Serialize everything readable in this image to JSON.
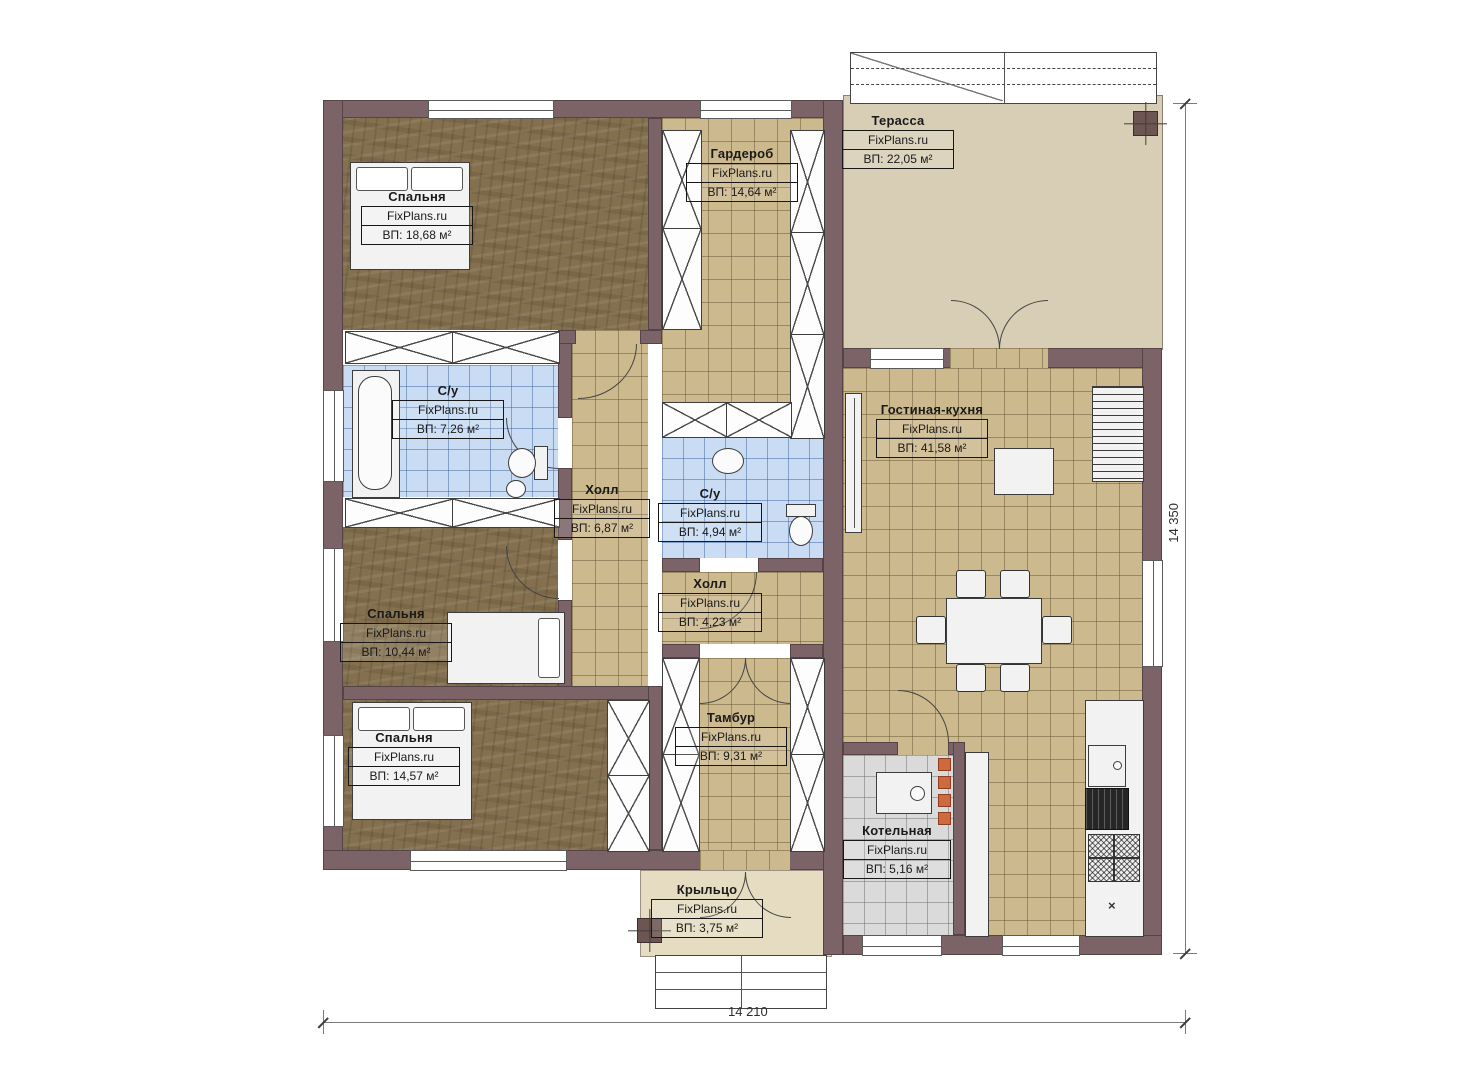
{
  "watermark": "FixPlans.ru",
  "rooms": [
    {
      "id": "bedroom-1",
      "name": "Спальня",
      "area": "ВП: 18,68 м²"
    },
    {
      "id": "wardrobe",
      "name": "Гардероб",
      "area": "ВП: 14,64 м²"
    },
    {
      "id": "terrace",
      "name": "Терасса",
      "area": "ВП: 22,05 м²"
    },
    {
      "id": "bath-1",
      "name": "С/у",
      "area": "ВП: 7,26 м²"
    },
    {
      "id": "hall-1",
      "name": "Холл",
      "area": "ВП: 6,87 м²"
    },
    {
      "id": "bath-2",
      "name": "С/у",
      "area": "ВП: 4,94 м²"
    },
    {
      "id": "living-kitchen",
      "name": "Гостиная-кухня",
      "area": "ВП: 41,58 м²"
    },
    {
      "id": "hall-2",
      "name": "Холл",
      "area": "ВП: 4,23 м²"
    },
    {
      "id": "bedroom-2",
      "name": "Спальня",
      "area": "ВП: 10,44 м²"
    },
    {
      "id": "bedroom-3",
      "name": "Спальня",
      "area": "ВП: 14,57 м²"
    },
    {
      "id": "vestibule",
      "name": "Тамбур",
      "area": "ВП: 9,31 м²"
    },
    {
      "id": "boiler",
      "name": "Котельная",
      "area": "ВП: 5,16 м²"
    },
    {
      "id": "porch",
      "name": "Крыльцо",
      "area": "ВП: 3,75 м²"
    }
  ],
  "dimensions": {
    "bottom": "14 210",
    "right": "14 350"
  },
  "icons": {
    "cabinet_cross": "×"
  },
  "colors": {
    "wall": "#7b6367",
    "tile_floor": "#cdb98e",
    "wet_floor": "#cadcf3",
    "wood_floor": "#84704e",
    "terrace_floor": "#d8ceb5",
    "porch_floor": "#e5dcc1",
    "boiler_floor": "#dadada",
    "accent_orange": "#cf6a3e"
  }
}
